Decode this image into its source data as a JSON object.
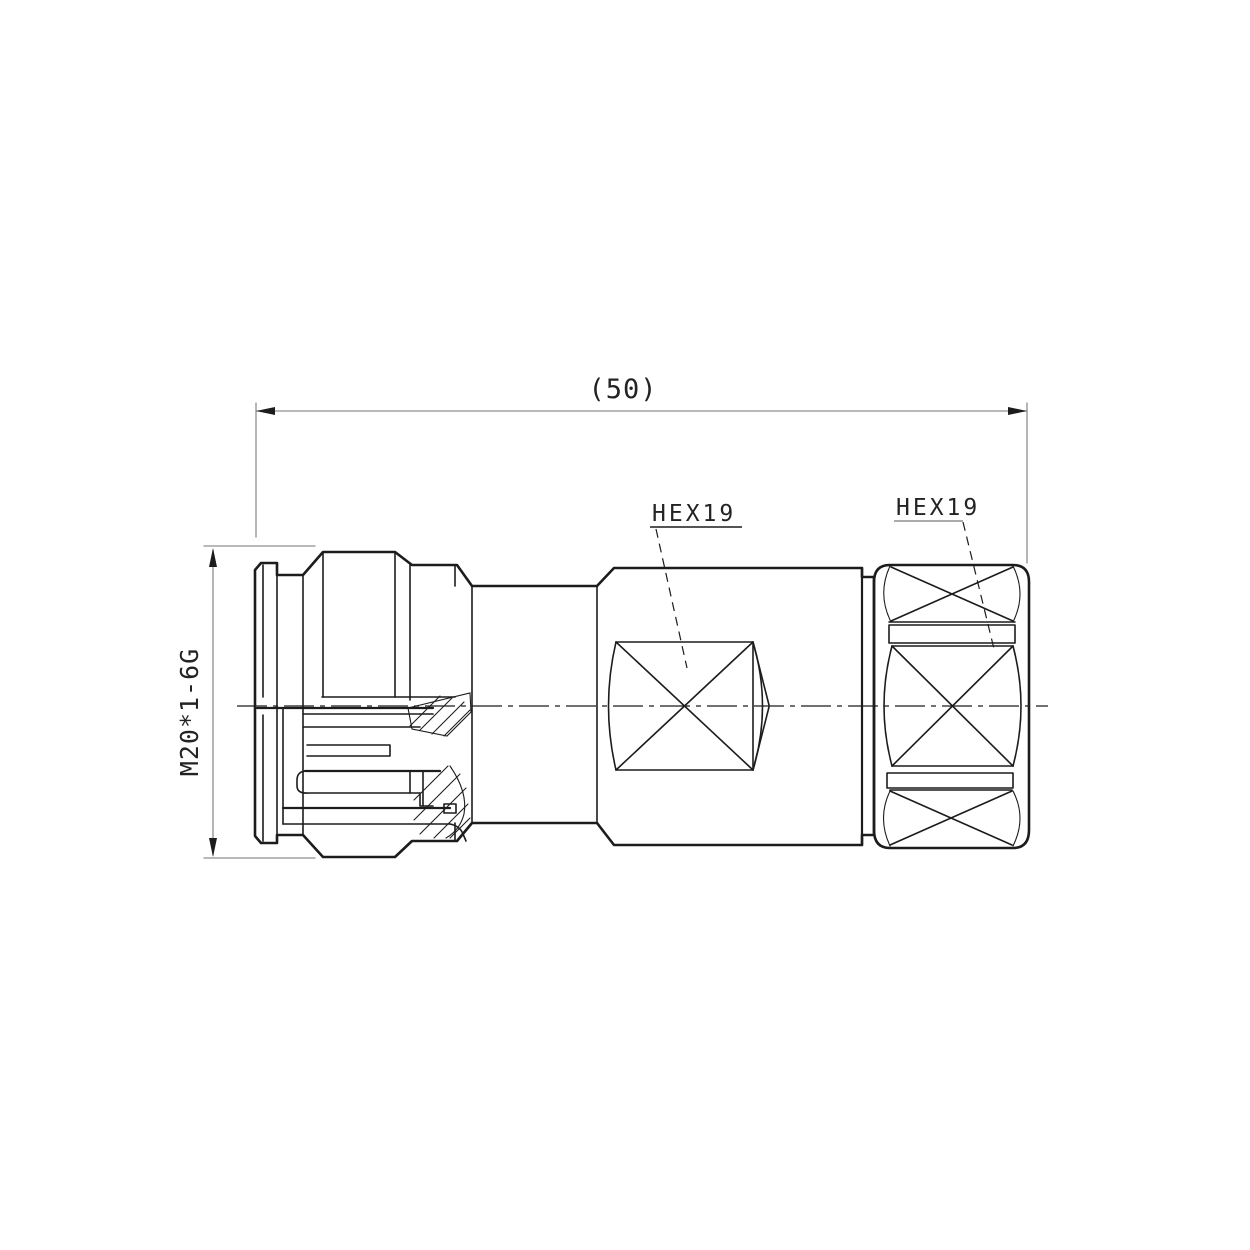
{
  "drawing": {
    "type": "technical-drawing",
    "subject": "RF coaxial connector, side cross-section view",
    "units_note": "dimensions in millimetres"
  },
  "labels": {
    "overall_length": "(50)",
    "thread_spec": "M20*1-6G",
    "hex_mid": "HEX19",
    "hex_right": "HEX19"
  },
  "dimensions": [
    {
      "name": "overall-length",
      "value": "(50)",
      "orientation": "horizontal",
      "position": "top"
    },
    {
      "name": "coupling-nut-thread",
      "value": "M20*1-6G",
      "orientation": "vertical",
      "position": "left"
    },
    {
      "name": "middle-hex-across-flats",
      "value": "HEX19",
      "leader": "dashed"
    },
    {
      "name": "rear-hex-across-flats",
      "value": "HEX19",
      "leader": "dashed"
    }
  ],
  "colors": {
    "line": "#1c1c1c",
    "dim": "#8f8f8f",
    "text": "#232323",
    "bg": "#ffffff"
  }
}
